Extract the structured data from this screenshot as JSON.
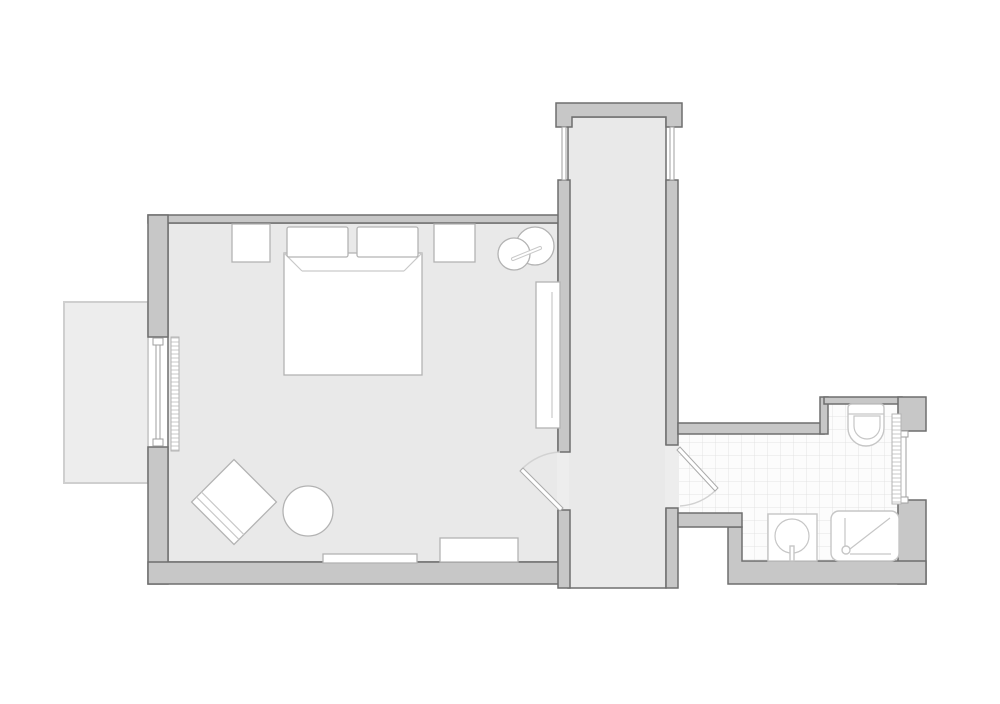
{
  "document": {
    "type": "architectural-floor-plan",
    "style": "grayscale line drawing, top-down view",
    "visible_text": [],
    "scale_or_labels_shown": false
  },
  "colors": {
    "background": "#ffffff",
    "floor": "#e9e9e9",
    "floorOutline": "#6f6f6f",
    "wall": "#c7c7c7",
    "wallOutline": "#6f6f6f",
    "openingFloor": "#ededed",
    "balcony": "#ededed",
    "balconyOutline": "#cfcfcf",
    "tileBase": "#fcfcfc",
    "tileLine": "#e3e3e3",
    "furniture": "#ffffff",
    "furnitureOutline": "#b3b3b3",
    "detailLine": "#c9c9c9",
    "fixtureOutline": "#c6c6c6",
    "doorLeaf": "#ffffff",
    "doorOutline": "#ababab",
    "swingArc": "#d2d2d2",
    "glazing": "#9f9f9f",
    "radiatorHatch": "#c9c9c9"
  },
  "plan": {
    "rooms": [
      {
        "id": "bedroom",
        "position": "large room, left",
        "floor_finish": "plain",
        "contents": [
          "double-bed",
          "pillow-left",
          "pillow-right",
          "nightstand-left",
          "nightstand-right",
          "lounge-chair-with-side-table",
          "wardrobe-console",
          "armchair",
          "round-side-table",
          "bench",
          "baseboard-radiator",
          "window-radiator"
        ]
      },
      {
        "id": "corridor",
        "position": "vertical hall, center; open at bottom edge of drawing",
        "floor_finish": "plain",
        "contents": []
      },
      {
        "id": "bathroom",
        "position": "right, lower",
        "floor_finish": "tiled grid",
        "contents": [
          "toilet",
          "towel-radiator",
          "wash-basin-vanity",
          "shower-tray"
        ]
      },
      {
        "id": "balcony",
        "position": "outside west wall of bedroom",
        "floor_finish": "plain outline",
        "contents": []
      }
    ],
    "doors": [
      {
        "id": "bedroom-door",
        "between": [
          "bedroom",
          "corridor"
        ],
        "swing": "into bedroom, hinged at south jamb"
      },
      {
        "id": "bathroom-door",
        "between": [
          "corridor",
          "bathroom"
        ],
        "swing": "into bathroom, hinged at north jamb"
      }
    ],
    "windows": [
      {
        "id": "bedroom-west-window",
        "wall": "west, facing balcony"
      },
      {
        "id": "corridor-north-window-left",
        "wall": "north lintel, left side"
      },
      {
        "id": "corridor-north-window-right",
        "wall": "north lintel, right side"
      },
      {
        "id": "bathroom-east-window",
        "wall": "east"
      }
    ]
  }
}
